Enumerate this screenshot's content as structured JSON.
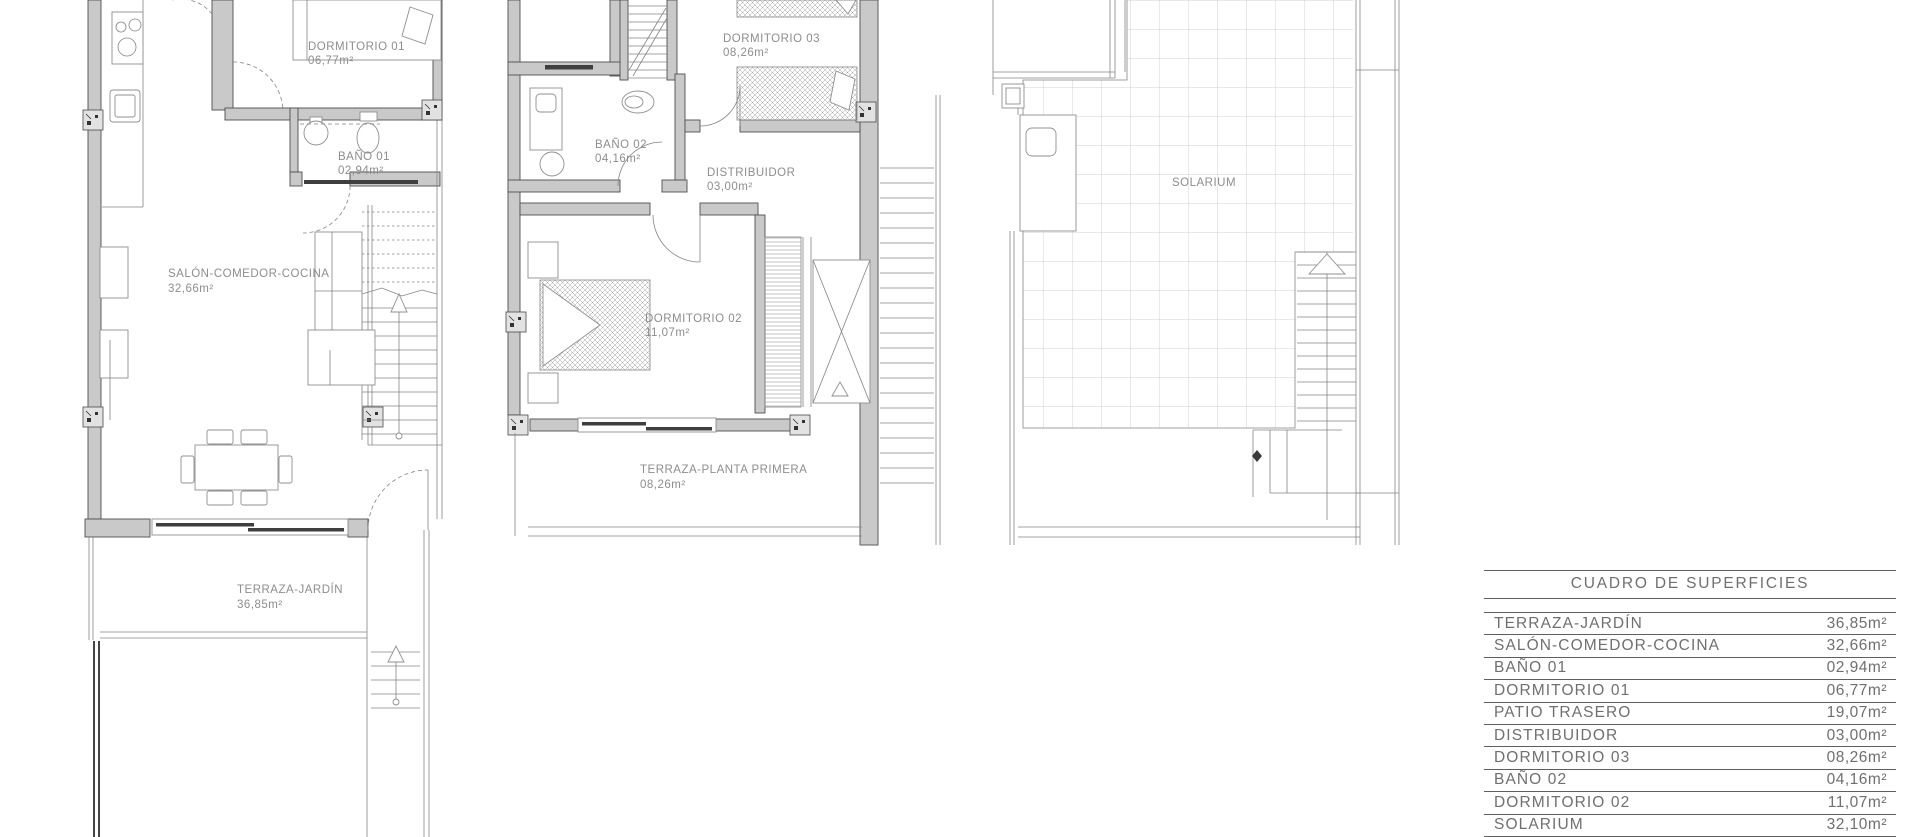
{
  "palette": {
    "background": "#ffffff",
    "wall_fill": "#c9c9c9",
    "wall_stroke": "#4e4e4e",
    "thin_line": "#848484",
    "dark_glass": "#3f3f3f",
    "plan_label_text": "#8d8d8d",
    "table_text": "#6f6f6f",
    "table_rule": "#5f5f5f"
  },
  "plans": {
    "ground_floor": {
      "labels": [
        {
          "name": "DORMITORIO 01",
          "area": "06,77m²"
        },
        {
          "name": "BAÑO 01",
          "area": "02,94m²"
        },
        {
          "name": "SALÓN-COMEDOR-COCINA",
          "area": "32,66m²"
        },
        {
          "name": "TERRAZA-JARDÍN",
          "area": "36,85m²"
        }
      ]
    },
    "first_floor": {
      "labels": [
        {
          "name": "DORMITORIO 03",
          "area": "08,26m²"
        },
        {
          "name": "BAÑO 02",
          "area": "04,16m²"
        },
        {
          "name": "DISTRIBUIDOR",
          "area": "03,00m²"
        },
        {
          "name": "DORMITORIO 02",
          "area": "11,07m²"
        },
        {
          "name": "TERRAZA-PLANTA PRIMERA",
          "area": "08,26m²"
        }
      ]
    },
    "solarium": {
      "labels": [
        {
          "name": "SOLARIUM"
        }
      ]
    }
  },
  "surface_table": {
    "title": "CUADRO DE SUPERFICIES",
    "rows": [
      {
        "label": "TERRAZA-JARDÍN",
        "value": "36,85m²"
      },
      {
        "label": "SALÓN-COMEDOR-COCINA",
        "value": "32,66m²"
      },
      {
        "label": "BAÑO 01",
        "value": "02,94m²"
      },
      {
        "label": "DORMITORIO 01",
        "value": "06,77m²"
      },
      {
        "label": "PATIO TRASERO",
        "value": "19,07m²"
      },
      {
        "label": "DISTRIBUIDOR",
        "value": "03,00m²"
      },
      {
        "label": "DORMITORIO 03",
        "value": "08,26m²"
      },
      {
        "label": "BAÑO 02",
        "value": "04,16m²"
      },
      {
        "label": "DORMITORIO 02",
        "value": "11,07m²"
      },
      {
        "label": "SOLARIUM",
        "value": "32,10m²"
      }
    ]
  }
}
